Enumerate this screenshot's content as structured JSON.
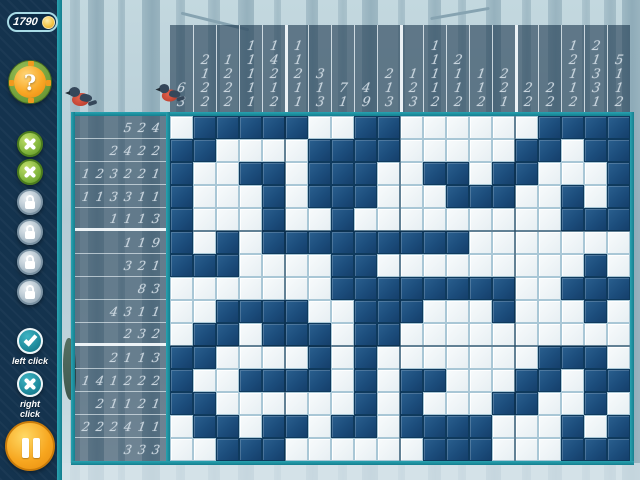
{
  "hud": {
    "score": "1790",
    "coin_icon": "coin-icon",
    "hint_button": {
      "icon": "question-mark-icon",
      "glyph": "?"
    },
    "mistake_buttons": [
      {
        "icon": "x-icon"
      },
      {
        "icon": "x-icon"
      }
    ],
    "lock_buttons": [
      {
        "icon": "padlock-icon"
      },
      {
        "icon": "padlock-icon"
      },
      {
        "icon": "padlock-icon"
      },
      {
        "icon": "padlock-icon"
      }
    ],
    "fill_help": {
      "icon": "check-icon",
      "label": "left click"
    },
    "mark_help": {
      "icon": "x-icon",
      "label": "right click"
    },
    "pause_button": {
      "icon": "pause-icon"
    }
  },
  "colors": {
    "accent_teal": "#1f97a6",
    "sidebar_navy": "#14334e",
    "filled_cell": "#1c4d7c",
    "empty_cell": "#eef4f8",
    "clue_digit": "#c9d5de",
    "hint_orange": "#f9a826",
    "life_green": "#7fb33b",
    "pause_orange": "#f7a61f"
  },
  "board": {
    "cols": 20,
    "rows": 15,
    "col_clues": [
      [
        6,
        3
      ],
      [
        2,
        1,
        2,
        2
      ],
      [
        1,
        2,
        2,
        2
      ],
      [
        1,
        1,
        1,
        1,
        1
      ],
      [
        1,
        4,
        2,
        1,
        2
      ],
      [
        1,
        1,
        2,
        1,
        1
      ],
      [
        3,
        1,
        3
      ],
      [
        7,
        1
      ],
      [
        4,
        9
      ],
      [
        2,
        1,
        3
      ],
      [
        1,
        2,
        3
      ],
      [
        1,
        1,
        1,
        1,
        2
      ],
      [
        2,
        1,
        1,
        2
      ],
      [
        1,
        1,
        2
      ],
      [
        2,
        2,
        1
      ],
      [
        2,
        2
      ],
      [
        2,
        2
      ],
      [
        1,
        2,
        1,
        1,
        2
      ],
      [
        2,
        1,
        3,
        3,
        1
      ],
      [
        5,
        1,
        1,
        2
      ]
    ],
    "row_clues": [
      [
        5,
        2,
        4
      ],
      [
        2,
        4,
        2,
        2
      ],
      [
        1,
        2,
        3,
        2,
        2,
        1
      ],
      [
        1,
        1,
        3,
        3,
        1,
        1
      ],
      [
        1,
        1,
        1,
        3
      ],
      [
        1,
        1,
        9
      ],
      [
        3,
        2,
        1
      ],
      [
        8,
        3
      ],
      [
        4,
        3,
        1,
        1
      ],
      [
        2,
        3,
        2
      ],
      [
        2,
        1,
        1,
        3
      ],
      [
        1,
        4,
        1,
        2,
        2,
        2
      ],
      [
        2,
        1,
        1,
        2,
        1
      ],
      [
        2,
        2,
        2,
        4,
        1,
        1
      ],
      [
        3,
        3,
        3
      ]
    ],
    "grid": [
      "01111100110000001111",
      "11000011110000011011",
      "10011011100110110001",
      "10001011100011100101",
      "10001001000000000111",
      "10101111111110000000",
      "11100001100000000010",
      "00000001111111100111",
      "00111100111000100010",
      "01101110110000000000",
      "11000010100000001110",
      "10011110101100011011",
      "11000000101000110010",
      "01101101101111000101",
      "00111000000111000111"
    ]
  }
}
